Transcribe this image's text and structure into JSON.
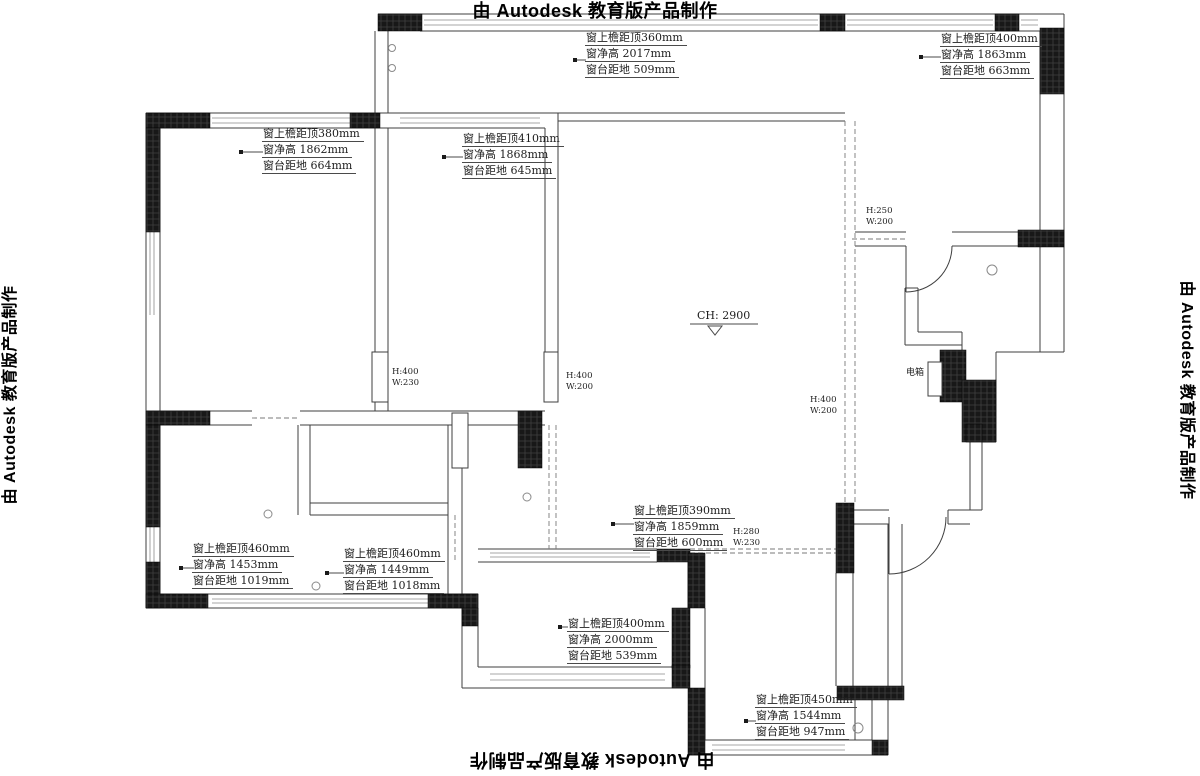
{
  "watermark": {
    "text": "由 Autodesk 教育版产品制作"
  },
  "ceiling_height": {
    "label": "CH: 2900"
  },
  "electrical_box": {
    "label": "电箱"
  },
  "window_annotations": [
    {
      "position": "top-center",
      "lines": [
        "窗上檐距顶360mm",
        "窗净高  2017mm",
        "窗台距地 509mm"
      ]
    },
    {
      "position": "top-right",
      "lines": [
        "窗上檐距顶400mm",
        "窗净高  1863mm",
        "窗台距地 663mm"
      ]
    },
    {
      "position": "upper-left",
      "lines": [
        "窗上檐距顶380mm",
        "窗净高 1862mm",
        "窗台距地 664mm"
      ]
    },
    {
      "position": "upper-middle",
      "lines": [
        "窗上檐距顶410mm",
        "窗净高  1868mm",
        "窗台距地 645mm"
      ]
    },
    {
      "position": "lower-left",
      "lines": [
        "窗上檐距顶460mm",
        "窗净高  1453mm",
        "窗台距地 1019mm"
      ]
    },
    {
      "position": "lower-middle",
      "lines": [
        "窗上檐距顶460mm",
        "窗净高  1449mm",
        "窗台距地 1018mm"
      ]
    },
    {
      "position": "center-bottom",
      "lines": [
        "窗上檐距顶390mm",
        "窗净高  1859mm",
        "窗台距地 600mm"
      ]
    },
    {
      "position": "bottom-middle",
      "lines": [
        "窗上檐距顶400mm",
        "窗净高  2000mm",
        "窗台距地 539mm"
      ]
    },
    {
      "position": "bottom-right",
      "lines": [
        "窗上檐距顶450mm",
        "窗净高  1544mm",
        "窗台距地 947mm"
      ]
    }
  ],
  "opening_labels": [
    {
      "position": "top-right-passage",
      "height": "H:250",
      "width": "W:200"
    },
    {
      "position": "left-bedroom-door",
      "height": "H:400",
      "width": "W:230"
    },
    {
      "position": "middle-bedroom-door",
      "height": "H:400",
      "width": "W:200"
    },
    {
      "position": "corridor-opening",
      "height": "H:400",
      "width": "W:200"
    },
    {
      "position": "entry-opening",
      "height": "H:280",
      "width": "W:230"
    }
  ],
  "colors": {
    "background": "#ffffff",
    "wall_fill": "#181818",
    "line": "#3f3f3f"
  }
}
